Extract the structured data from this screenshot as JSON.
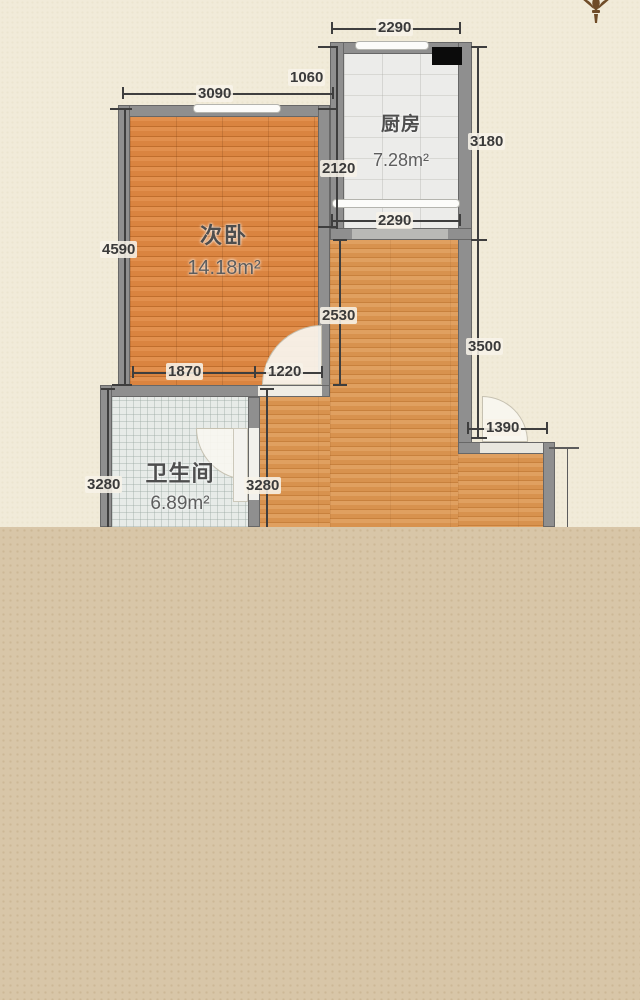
{
  "plan": {
    "rooms": [
      {
        "id": "kitchen",
        "name": "厨房",
        "area": "7.28m²"
      },
      {
        "id": "bedroom",
        "name": "次卧",
        "area": "14.18m²"
      },
      {
        "id": "bathroom",
        "name": "卫生间",
        "area": "6.89m²"
      }
    ],
    "dimensions": {
      "kitchen_top_2290": "2290",
      "gap_1060": "1060",
      "bedroom_top_3090": "3090",
      "kitchen_right_3180": "3180",
      "kitchen_left_2120": "2120",
      "bedroom_left_4590": "4590",
      "kitchen_bottom_2290": "2290",
      "hall_left_2530": "2530",
      "hall_right_3500": "3500",
      "bedroom_bottom_1870": "1870",
      "bedroom_door_1220": "1220",
      "entry_1390": "1390",
      "bath_left_3280": "3280",
      "bath_right_3280": "3280"
    },
    "colors": {
      "background_upper": "#f1ebd9",
      "background_lower": "#d8c6a8",
      "wall": "#8f8f8f",
      "bedroom_floor": "#dd8a46",
      "hall_floor": "#dc9a58",
      "kitchen_floor": "#eaeae8",
      "bathroom_floor": "#e7ebe8",
      "dimension_text": "#3a3a3a"
    }
  }
}
